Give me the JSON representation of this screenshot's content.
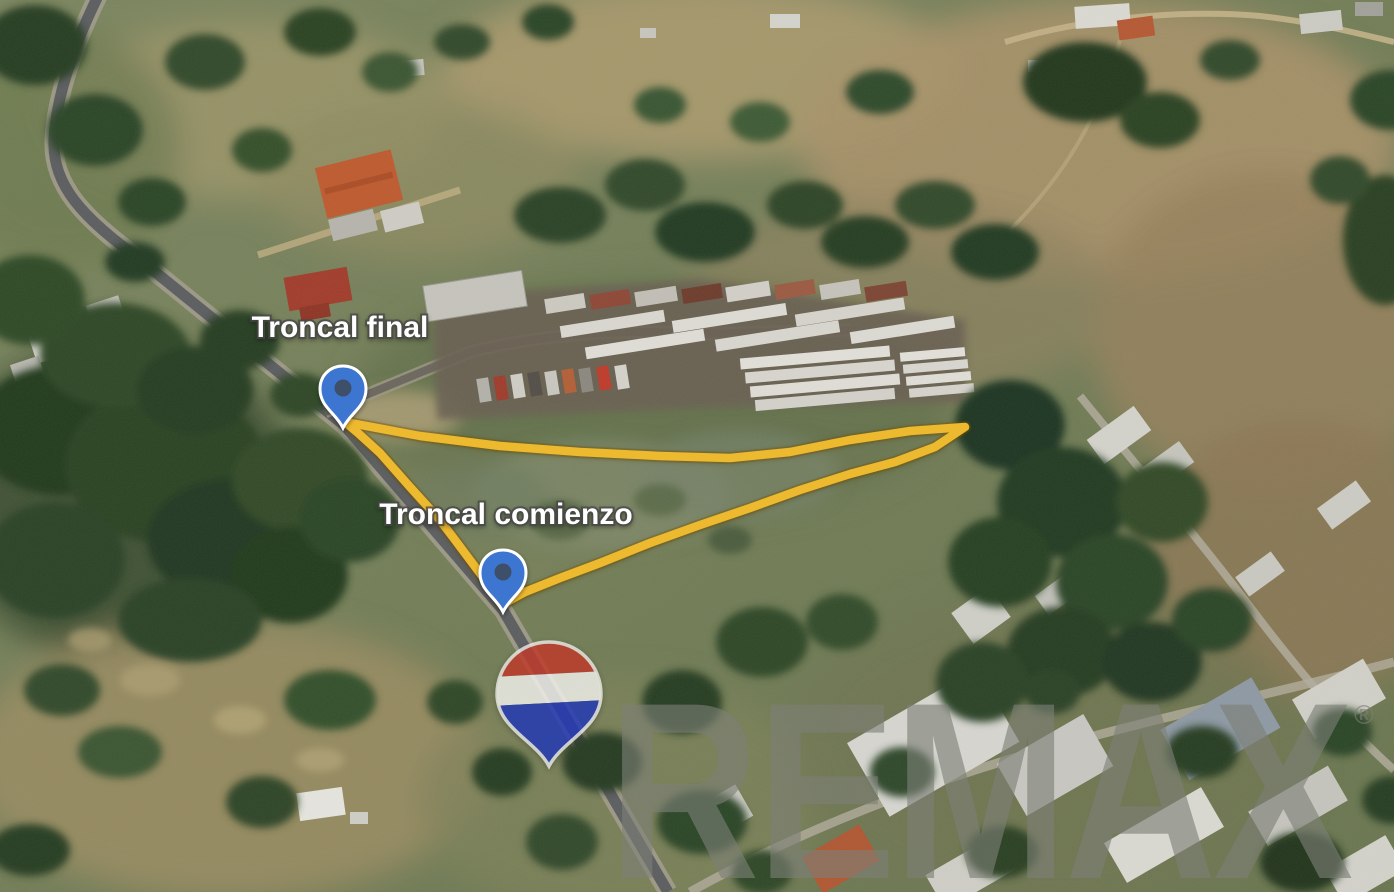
{
  "map": {
    "type": "aerial-property-map",
    "labels": [
      {
        "id": "label-troncal-final",
        "text": "Troncal final",
        "x": 340,
        "y": 337
      },
      {
        "id": "label-troncal-comienzo",
        "text": "Troncal comienzo",
        "x": 506,
        "y": 524
      }
    ],
    "markers": [
      {
        "id": "pin-troncal-final",
        "x": 343,
        "y": 428
      },
      {
        "id": "pin-troncal-comienzo",
        "x": 503,
        "y": 612
      }
    ],
    "marker_color": "#3C76D1",
    "marker_dot_color": "#3E4B5D",
    "boundary": {
      "color": "#EDB92F",
      "points": [
        [
          345,
          422
        ],
        [
          420,
          436
        ],
        [
          500,
          446
        ],
        [
          580,
          452
        ],
        [
          660,
          456
        ],
        [
          730,
          458
        ],
        [
          790,
          452
        ],
        [
          850,
          440
        ],
        [
          910,
          431
        ],
        [
          965,
          427
        ],
        [
          935,
          447
        ],
        [
          895,
          462
        ],
        [
          850,
          474
        ],
        [
          800,
          490
        ],
        [
          750,
          508
        ],
        [
          700,
          525
        ],
        [
          650,
          543
        ],
        [
          600,
          563
        ],
        [
          560,
          578
        ],
        [
          525,
          592
        ],
        [
          503,
          604
        ],
        [
          470,
          560
        ],
        [
          440,
          520
        ],
        [
          410,
          487
        ],
        [
          380,
          453
        ],
        [
          358,
          433
        ]
      ]
    },
    "watermark": {
      "brand": "REMAX",
      "registered": "®",
      "text_color_rgba": "rgba(125,128,118,0.62)",
      "balloon": {
        "red": "#BE3A2B",
        "white": "#EFEFEA",
        "blue": "#2238B5"
      }
    }
  }
}
